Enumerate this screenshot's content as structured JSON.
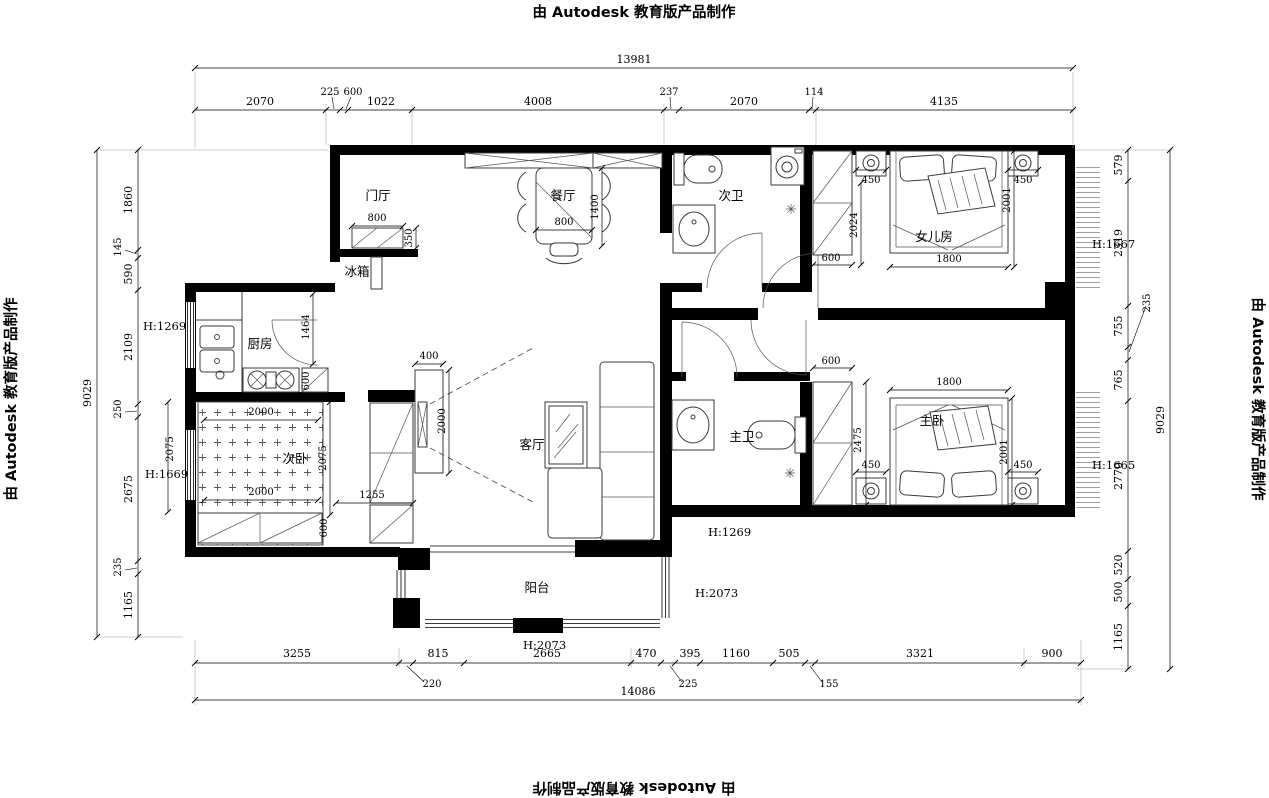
{
  "watermark": {
    "text": "由 Autodesk 教育版产品制作"
  },
  "rooms": {
    "entry": "门厅",
    "fridge": "冰箱",
    "dining": "餐厅",
    "bath2": "次卫",
    "girl_room": "女儿房",
    "kitchen": "厨房",
    "bed2": "次卧",
    "living": "客厅",
    "bath1": "主卫",
    "master": "主卧",
    "balcony": "阳台"
  },
  "heights": {
    "kitchen_window": "H:1269",
    "bed2_window": "H:1669",
    "corridor": "H:1269",
    "balcony_door": "H:2073",
    "balcony_window": "H:2073",
    "girl_window": "H:1667",
    "master_window": "H:1665"
  },
  "dims": {
    "top_total": "13981",
    "top": [
      "2070",
      "225",
      "600",
      "1022",
      "4008",
      "237",
      "2070",
      "114",
      "4135"
    ],
    "left_total": "9029",
    "left": [
      "1860",
      "145",
      "590",
      "2109",
      "250",
      "2675",
      "235",
      "1165"
    ],
    "right": [
      "579",
      "2319",
      "755",
      "235",
      "765",
      "2770",
      "520",
      "500",
      "1165"
    ],
    "right_total": "9029",
    "bottom": [
      "3255",
      "220",
      "815",
      "2665",
      "470",
      "225",
      "395",
      "1160",
      "505",
      "155",
      "3321",
      "900"
    ],
    "bottom_total": "14086",
    "entry_width": "800",
    "entry_depth": "350",
    "dining_table_w": "800",
    "dining_table_l": "1400",
    "kitchen_door": "1464",
    "kitchen_cab": "600",
    "bed2_w": "2000",
    "bed2_l": "2000",
    "bed2_depth": "2075",
    "bed2_room": "2075",
    "bed2_open": "1255",
    "bed2_cab": "600",
    "tv_w": "400",
    "tv_l": "2000",
    "girl_wardrobe": "600",
    "girl_depth": "2024",
    "girl_ns_l": "450",
    "girl_ns_r": "450",
    "girl_bed": "1800",
    "girl_len": "2001",
    "m_wardrobe": "600",
    "m_depth": "2475",
    "m_ns_l": "450",
    "m_ns_r": "450",
    "m_bed": "1800",
    "m_len": "2001"
  }
}
